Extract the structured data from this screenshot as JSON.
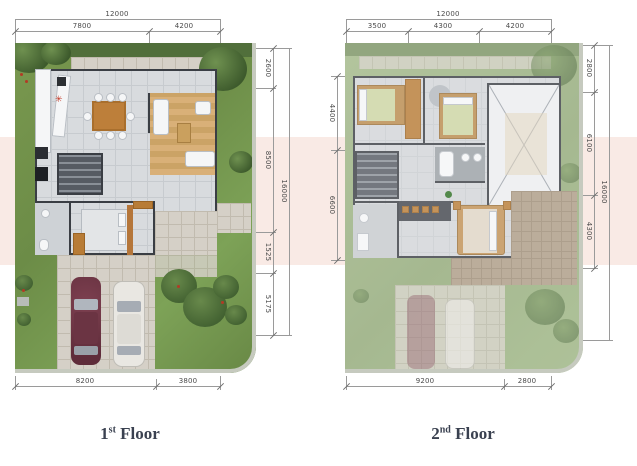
{
  "page": {
    "band_color": "#f9eae5"
  },
  "floor1": {
    "title": {
      "number": "1",
      "suffix": "st",
      "word": "Floor"
    },
    "marker": "✳",
    "dims": {
      "top_total": "12000",
      "top_segments": [
        "7800",
        "4200"
      ],
      "right_segments": [
        "2600",
        "8500",
        "1525",
        "5175"
      ],
      "right_total": "16000",
      "bottom_segments": [
        "8200",
        "3800"
      ]
    }
  },
  "floor2": {
    "title": {
      "number": "2",
      "suffix": "nd",
      "word": "Floor"
    },
    "dims": {
      "top_total": "12000",
      "top_segments": [
        "3500",
        "4300",
        "4200"
      ],
      "left_segments": [
        "4400",
        "6600"
      ],
      "right_segments": [
        "2800",
        "6100",
        "4300"
      ],
      "right_total": "16000",
      "bottom_segments": [
        "9200",
        "2800"
      ]
    }
  }
}
